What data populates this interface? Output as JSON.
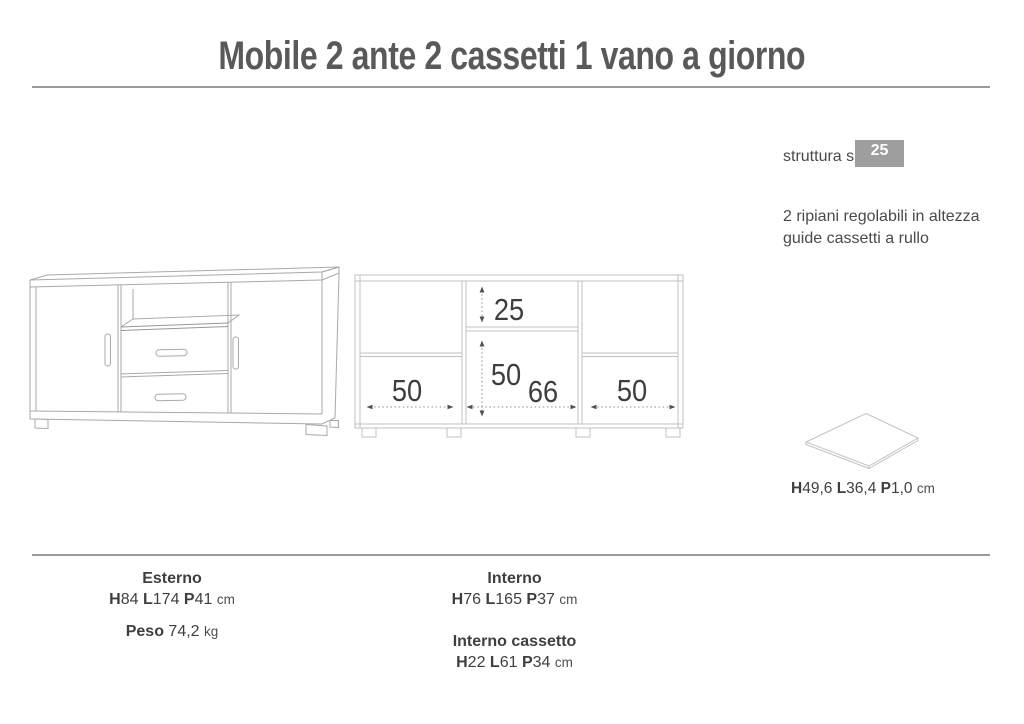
{
  "title": "Mobile 2 ante 2 cassetti 1 vano a giorno",
  "notes": {
    "struttura_label": "struttura sp.",
    "struttura_badge": "25 mm",
    "line1": "2 ripiani regolabili in altezza",
    "line2": "guide cassetti a rullo"
  },
  "front_view": {
    "vano_height": "25",
    "drawers_height": "50",
    "left_width": "50",
    "middle_width": "66",
    "right_width": "50"
  },
  "shelf_panel": {
    "dims": [
      {
        "b": "H"
      },
      {
        "t": "49,6 "
      },
      {
        "b": "L"
      },
      {
        "t": "36,4 "
      },
      {
        "b": "P"
      },
      {
        "t": "1,0 "
      },
      {
        "s": "cm"
      }
    ]
  },
  "specs": {
    "esterno_title": "Esterno",
    "esterno_dims": [
      {
        "b": "H"
      },
      {
        "t": "84 "
      },
      {
        "b": "L"
      },
      {
        "t": "174 "
      },
      {
        "b": "P"
      },
      {
        "t": "41 "
      },
      {
        "s": "cm"
      }
    ],
    "peso": [
      {
        "b": "Peso"
      },
      {
        "t": " 74,2 "
      },
      {
        "s": "kg"
      }
    ],
    "interno_title": "Interno",
    "interno_dims": [
      {
        "b": "H"
      },
      {
        "t": "76 "
      },
      {
        "b": "L"
      },
      {
        "t": "165 "
      },
      {
        "b": "P"
      },
      {
        "t": "37 "
      },
      {
        "s": "cm"
      }
    ],
    "cassetto_title": "Interno cassetto",
    "cassetto_dims": [
      {
        "b": "H"
      },
      {
        "t": "22 "
      },
      {
        "b": "L"
      },
      {
        "t": "61 "
      },
      {
        "b": "P"
      },
      {
        "t": "34 "
      },
      {
        "s": "cm"
      }
    ]
  },
  "colors": {
    "title_text": "#59595b",
    "body_text": "#3f3f3f",
    "rule_gray": "#9a9a9a",
    "badge_bg": "#9e9e9e",
    "badge_text": "#ffffff",
    "drawing_line": "#aaaaaa",
    "dimension_arrow": "#4f4f4f"
  }
}
